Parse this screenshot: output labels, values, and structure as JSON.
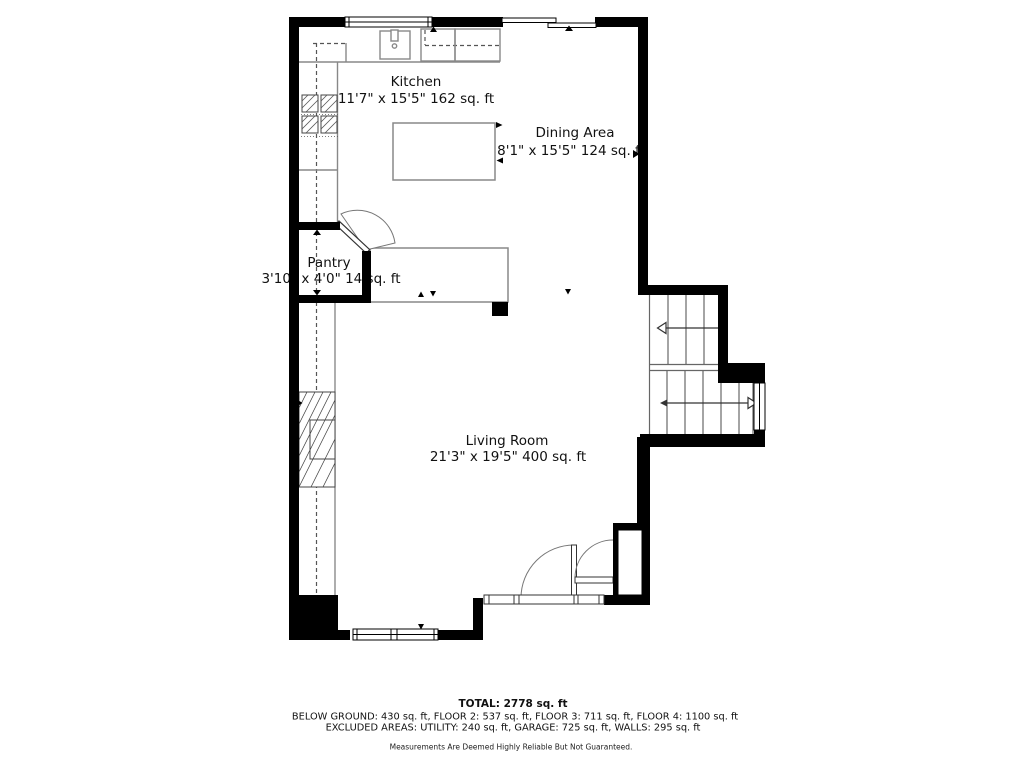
{
  "plan": {
    "rooms": {
      "kitchen": {
        "name": "Kitchen",
        "dims": "11'7\" x 15'5\" 162 sq. ft"
      },
      "dining": {
        "name": "Dining Area",
        "dims": "8'1\" x 15'5\" 124 sq. ft"
      },
      "pantry": {
        "name": "Pantry",
        "dims": "3'10\" x 4'0\" 14 sq. ft"
      },
      "living": {
        "name": "Living Room",
        "dims": "21'3\" x 19'5\" 400 sq. ft"
      }
    },
    "fixtures": [
      "sink",
      "stove",
      "kitchen-island",
      "bar-counter",
      "fireplace",
      "stairs",
      "doors",
      "windows"
    ]
  },
  "footer": {
    "total": "TOTAL: 2778 sq. ft",
    "floors": "BELOW GROUND: 430 sq. ft, FLOOR 2: 537 sq. ft, FLOOR 3: 711 sq. ft, FLOOR 4: 1100 sq. ft",
    "excluded": "EXCLUDED AREAS: UTILITY: 240 sq. ft, GARAGE: 725 sq. ft, WALLS: 295 sq. ft",
    "disclaimer": "Measurements Are Deemed Highly Reliable But Not Guaranteed."
  },
  "colors": {
    "wall": "#000000",
    "fixture_line": "#888888",
    "text": "#111111",
    "background": "#ffffff"
  }
}
